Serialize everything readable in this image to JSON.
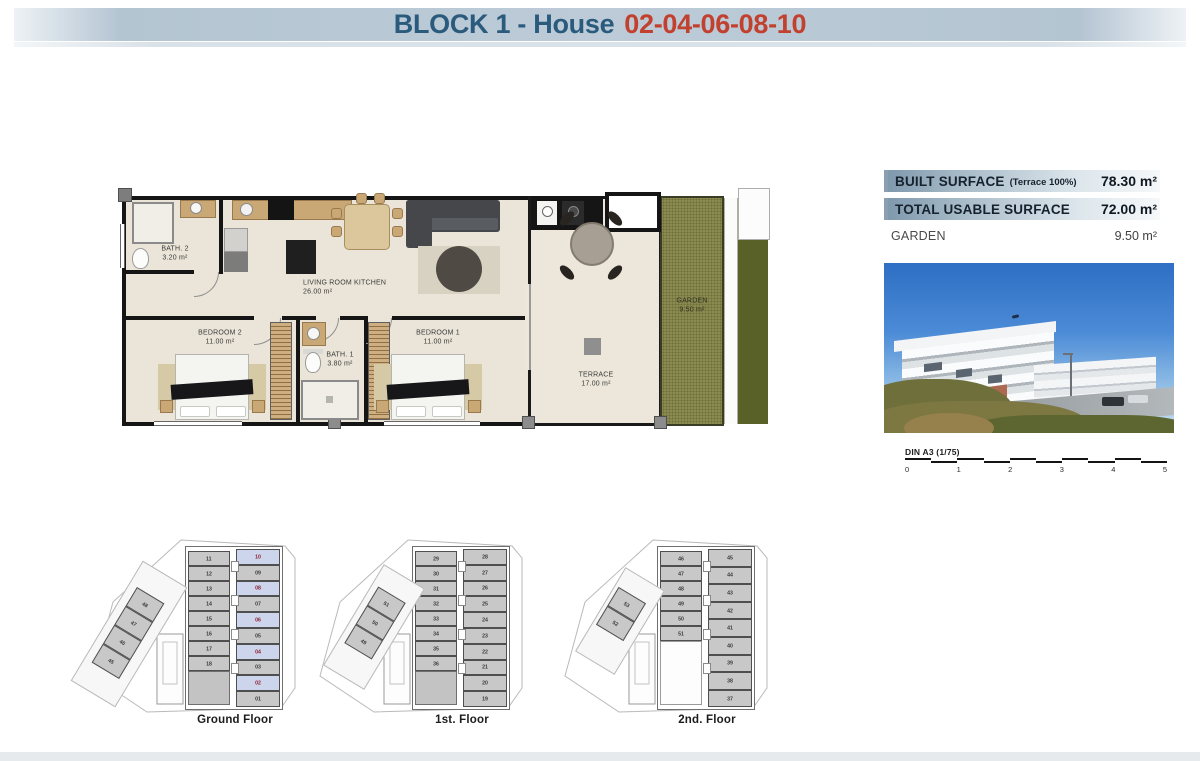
{
  "header": {
    "title": "BLOCK 1 - House",
    "house_numbers": "02-04-06-08-10"
  },
  "floor_plan": {
    "rooms": [
      {
        "name": "BATH. 2",
        "area": "3.20 m²"
      },
      {
        "name": "LIVING ROOM KITCHEN",
        "area": "26.00 m²"
      },
      {
        "name": "BEDROOM 2",
        "area": "11.00 m²"
      },
      {
        "name": "BATH. 1",
        "area": "3.80 m²"
      },
      {
        "name": "BEDROOM 1",
        "area": "11.00 m²"
      },
      {
        "name": "TERRACE",
        "area": "17.00 m²"
      },
      {
        "name": "GARDEN",
        "area": "9.50 m²"
      }
    ]
  },
  "surface_table": {
    "rows": [
      {
        "label": "BUILT SURFACE",
        "note": "(Terrace 100%)",
        "value": "78.30 m²",
        "highlight": true
      },
      {
        "label": "TOTAL USABLE SURFACE",
        "note": "",
        "value": "72.00 m²",
        "highlight": true
      },
      {
        "label": "GARDEN",
        "note": "",
        "value": "9.50 m²",
        "highlight": false
      }
    ]
  },
  "scale_bar": {
    "label": "DIN A3 (1/75)",
    "ticks": [
      "0",
      "1",
      "2",
      "3",
      "4",
      "5"
    ]
  },
  "key_plans": [
    {
      "caption": "Ground Floor",
      "left_units": [
        "11",
        "12",
        "13",
        "14",
        "15",
        "16",
        "17",
        "18"
      ],
      "right_units": [
        "10",
        "09",
        "08",
        "07",
        "06",
        "05",
        "04",
        "03",
        "02",
        "01"
      ],
      "diagonal_units": [
        "48",
        "47",
        "46",
        "45"
      ],
      "highlighted_units": [
        "10",
        "08",
        "06",
        "04",
        "02"
      ]
    },
    {
      "caption": "1st. Floor",
      "left_units": [
        "29",
        "30",
        "31",
        "32",
        "33",
        "34",
        "35",
        "36"
      ],
      "right_units": [
        "28",
        "27",
        "26",
        "25",
        "24",
        "23",
        "22",
        "21",
        "20",
        "19"
      ],
      "diagonal_units": [
        "51",
        "50",
        "49"
      ],
      "highlighted_units": []
    },
    {
      "caption": "2nd. Floor",
      "left_units": [
        "46",
        "47",
        "48",
        "49",
        "50",
        "51"
      ],
      "right_units": [
        "45",
        "44",
        "43",
        "42",
        "41",
        "40",
        "39",
        "38",
        "37"
      ],
      "diagonal_units": [
        "53",
        "52"
      ],
      "highlighted_units": []
    }
  ],
  "colors": {
    "title_blue": "#2a5b7d",
    "title_red": "#c2402e",
    "table_gradient_start": "#7f99ad",
    "highlight_unit_fill": "#ccd5ec",
    "highlight_unit_text": "#8e1f2f",
    "garden_green": "#82824a"
  }
}
